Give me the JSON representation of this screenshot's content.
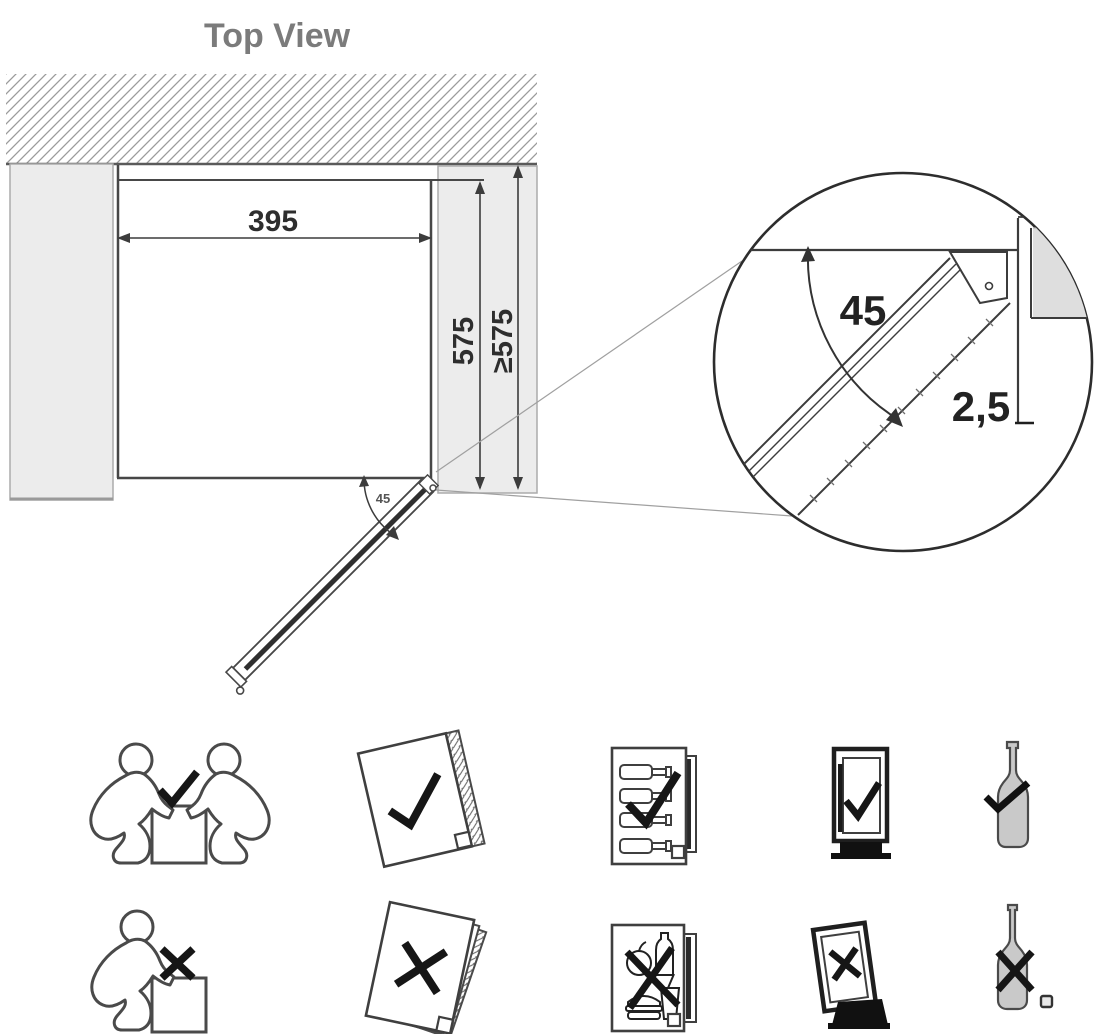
{
  "page": {
    "title": "Top View"
  },
  "diagram": {
    "niche_width_mm": "395",
    "niche_depth_mm": "575",
    "min_depth_mm": "≥575",
    "door_open_angle_deg": "45",
    "detail": {
      "angle_deg": "45",
      "gap_mm": "2,5"
    }
  },
  "icons": {
    "allowed": [
      {
        "name": "two-person-lift-check-icon",
        "meaning": "carry appliance with two people"
      },
      {
        "name": "manual-check-icon",
        "meaning": "read the instruction manual"
      },
      {
        "name": "wine-list-booklet-check-icon",
        "meaning": "store wine bottles as shown"
      },
      {
        "name": "upright-cabinet-check-icon",
        "meaning": "keep cabinet upright"
      },
      {
        "name": "wine-bottle-check-icon",
        "meaning": "suitable for wine bottles"
      }
    ],
    "not_allowed": [
      {
        "name": "one-person-lift-cross-icon",
        "meaning": "do not carry alone"
      },
      {
        "name": "manual-cross-icon",
        "meaning": "do not discard the manual"
      },
      {
        "name": "food-booklet-cross-icon",
        "meaning": "do not store food"
      },
      {
        "name": "tilted-cabinet-cross-icon",
        "meaning": "do not tilt the cabinet"
      },
      {
        "name": "wine-bottle-cross-icon",
        "meaning": "unsuitable bottle storage"
      }
    ]
  },
  "colors": {
    "line": "#474747",
    "dim_line": "#3c3c3c",
    "title": "#7b7b7b",
    "gray_fill": "#ececec",
    "detail_gray": "#dedede",
    "hatch": "#9b9b9b",
    "mark": "#161616",
    "bottle_fill": "#c9c9c9"
  }
}
